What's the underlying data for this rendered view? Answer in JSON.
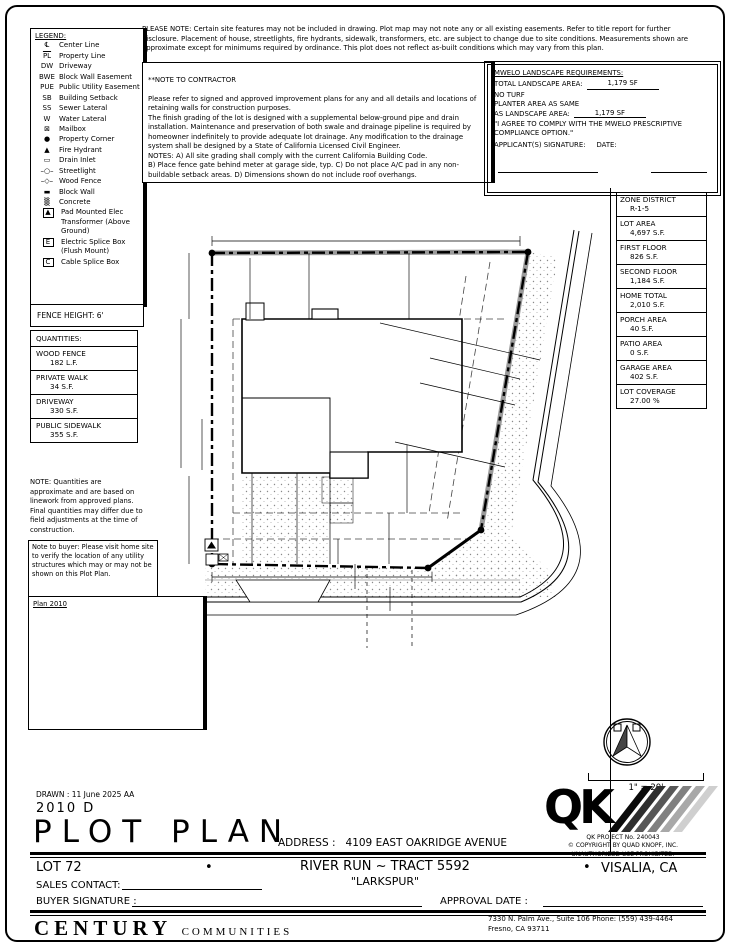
{
  "top_note": "PLEASE NOTE:  Certain site features may not be included in drawing.  Plot map may not note any or all existing easements.  Refer to title report for further disclosure.  Placement of house, streetlights, fire hydrants, sidewalk, transformers, etc. are subject to change due to site conditions.  Measurements shown are approximate except for minimums required by ordinance.  This plot does not reflect as-built conditions which may vary from this plan.",
  "contractor_note": {
    "title": "**NOTE TO CONTRACTOR",
    "body": "Please refer to signed and approved improvement plans for any and all details and locations of retaining walls for construction purposes.\nThe finish grading of the lot is designed with a supplemental below-ground pipe and drain installation.  Maintenance and preservation of both swale and drainage pipeline is required by homeowner indefinitely to provide adequate lot drainage.  Any modification to the drainage system shall be designed by a State of California Licensed Civil Engineer.\nNOTES:  A) All site grading shall comply with the current California Building Code.\nB) Place fence gate behind meter at garage side, typ.  C) Do not place A/C pad in any non-buildable setback areas.  D) Dimensions shown do not include roof overhangs."
  },
  "mwelo": {
    "title": "MWELO LANDSCAPE REQUIREMENTS:",
    "total_label": "TOTAL LANDSCAPE AREA:",
    "total_value": "1,179 SF",
    "no_turf": "NO TURF",
    "planter_label1": "PLANTER AREA AS SAME",
    "planter_label2": "AS LANDSCAPE AREA:",
    "planter_value": "1,179 SF",
    "agree": "\"I AGREE TO COMPLY WITH THE MWELO PRESCRIPTIVE COMPLIANCE OPTION.\"",
    "signature_label": "APPLICANT(S) SIGNATURE:",
    "date_label": "DATE:"
  },
  "legend": {
    "title": "LEGEND:",
    "items": [
      {
        "sym": "℄",
        "name": "centerline-icon",
        "label": "Center Line"
      },
      {
        "sym": "PL",
        "ov": 1,
        "name": "property-line-icon",
        "label": "Property Line"
      },
      {
        "sym": "DW",
        "name": "driveway-abbr",
        "label": "Driveway"
      },
      {
        "sym": "BWE",
        "name": "block-wall-easement-abbr",
        "label": "Block Wall Easement"
      },
      {
        "sym": "PUE",
        "name": "public-utility-easement-abbr",
        "label": "Public Utility Easement"
      },
      {
        "sym": "SB",
        "name": "building-setback-abbr",
        "label": "Building Setback"
      },
      {
        "sym": "SS",
        "name": "sewer-lateral-abbr",
        "label": "Sewer Lateral"
      },
      {
        "sym": "W",
        "name": "water-lateral-abbr",
        "label": "Water Lateral"
      },
      {
        "sym": "⊠",
        "name": "mailbox-icon",
        "label": "Mailbox"
      },
      {
        "sym": "●",
        "name": "property-corner-icon",
        "label": "Property Corner"
      },
      {
        "sym": "▲",
        "name": "fire-hydrant-icon",
        "label": "Fire Hydrant"
      },
      {
        "sym": "▭",
        "name": "drain-inlet-icon",
        "label": "Drain Inlet"
      },
      {
        "sym": "–○–",
        "name": "streetlight-icon",
        "label": "Streetlight"
      },
      {
        "sym": "–◇–",
        "name": "wood-fence-icon",
        "label": "Wood Fence"
      },
      {
        "sym": "▬",
        "name": "block-wall-icon",
        "label": "Block Wall"
      },
      {
        "sym": "▒",
        "name": "concrete-icon",
        "label": "Concrete"
      },
      {
        "sym": "▲",
        "boxed": 1,
        "name": "transformer-icon",
        "label": "Pad Mounted Elec Transformer (Above Ground)"
      },
      {
        "sym": "E",
        "boxed": 1,
        "name": "electric-splice-box-icon",
        "label": "Electric Splice Box (Flush Mount)"
      },
      {
        "sym": "C",
        "boxed": 1,
        "name": "cable-splice-box-icon",
        "label": "Cable Splice Box"
      }
    ]
  },
  "fence_height": "FENCE HEIGHT: 6'",
  "quantities": {
    "title": "QUANTITIES:",
    "items": [
      {
        "name": "WOOD FENCE",
        "value": "182 L.F."
      },
      {
        "name": "PRIVATE WALK",
        "value": "34 S.F."
      },
      {
        "name": "DRIVEWAY",
        "value": "330 S.F."
      },
      {
        "name": "PUBLIC SIDEWALK",
        "value": "355 S.F."
      }
    ]
  },
  "quantities_note": "NOTE: Quantities are approximate and are based on linework from approved plans. Final quantities may differ due to field adjustments at the time of construction.",
  "buyer_note": "Note to buyer: Please visit home site to verify the location of any utility structures which may or may not be shown on this Plot Plan.",
  "pv": {
    "title": "Plan 2010",
    "lines": [
      {
        "t": "PV SYSTEM:",
        "i": 0
      },
      {
        "t": "INVERTER:",
        "i": 1
      },
      {
        "t": "SOLAREDGE SE 3800H-USSR",
        "i": 2
      },
      {
        "t": "SOLAR MODULE TYPE:",
        "i": 1
      },
      {
        "t": "JASOLAR, JAM54S31-405/MR",
        "i": 2
      },
      {
        "t": "SYSTEM SIZE:",
        "i": 1
      },
      {
        "t": "12 MODULES 4.86Kw DC/",
        "i": 2
      },
      {
        "t": "3.800KW AC (405w)",
        "i": 2
      },
      {
        "t": "ENERGY STORAGE SYSTEM:",
        "i": 1
      },
      {
        "t": "(1) TELSA POWERWALL 2,",
        "i": 2
      },
      {
        "t": "13.5kWh, 5kW",
        "i": 2
      }
    ]
  },
  "zone_table": {
    "rows": [
      {
        "label": "ZONE DISTRICT",
        "value": "R-1-5"
      },
      {
        "label": "LOT AREA",
        "value": "4,697 S.F."
      },
      {
        "label": "FIRST FLOOR",
        "value": "826 S.F."
      },
      {
        "label": "SECOND FLOOR",
        "value": "1,184 S.F."
      },
      {
        "label": "HOME TOTAL",
        "value": "2,010 S.F."
      },
      {
        "label": "PORCH AREA",
        "value": "40 S.F."
      },
      {
        "label": "PATIO AREA",
        "value": "0 S.F."
      },
      {
        "label": "GARAGE AREA",
        "value": "402 S.F."
      },
      {
        "label": "LOT COVERAGE",
        "value": "27.00 %"
      }
    ]
  },
  "side_notes": [
    "All easements, structures, utility lines, underground systems & conditions affecting construction on the parcel must be shown & are the responsibility of the applicant. The issuance of a permit does not grant to any person the right to violate City or State Law.",
    "Issuance of the building permit does not constitute approval of paving, concrete curbs, gutters, sidewalks & driveway approaches in street or alley right-of-way adjacent to the property. Separate permits are required for such work per applicable City standards. Issuance of a Certificate of Occupancy for the building is dependent upon prior satisfactory completion of required pavement and concrete work."
  ],
  "compass": {
    "n": "N",
    "scale": "1\" = 20'"
  },
  "qk": {
    "logo": "QK",
    "line1": "QK PROJECT No. 240043",
    "line2": "© COPYRIGHT BY QUAD KNOPF, INC.",
    "line3": "UNAUTHORIZED USE PROHIBITED."
  },
  "title_block": {
    "drawn": "DRAWN :  11 June 2025   AA",
    "plan_code": "2010  D",
    "title": "PLOT PLAN",
    "address_label": "ADDRESS :",
    "address": "4109 EAST OAKRIDGE AVENUE",
    "lot": "LOT  72",
    "bullet": "•",
    "tract": "RIVER RUN ~ TRACT 5592",
    "community": "\"LARKSPUR\"",
    "city": "VISALIA, CA",
    "sales_label": "SALES CONTACT:",
    "buyer_label": "BUYER SIGNATURE :",
    "approval_label": "APPROVAL DATE :"
  },
  "footer": {
    "brand_main": "CENTURY",
    "brand_sub": "COMMUNITIES",
    "addr1": "7330 N. Palm Ave., Suite 106    Phone:  (559) 439-4464",
    "addr2": "Fresno, CA  93711"
  },
  "site_plan": {
    "labels": [
      {
        "t": "72.89'",
        "x": 415,
        "y": 246,
        "s": 9
      },
      {
        "t": "PL",
        "x": 500,
        "y": 246,
        "s": 8,
        "ov": 1
      },
      {
        "t": "STEM WALL",
        "x": 372,
        "y": 266,
        "s": 8
      },
      {
        "t": "72",
        "x": 437,
        "y": 297,
        "s": 17,
        "b": 1
      },
      {
        "t": "16.24'",
        "x": 189,
        "y": 288,
        "r": -90,
        "s": 8
      },
      {
        "t": "16.26'",
        "x": 250,
        "y": 288,
        "r": -90,
        "s": 8
      },
      {
        "t": "15' SB",
        "x": 309,
        "y": 282,
        "r": -90,
        "s": 8
      },
      {
        "t": "16.33'",
        "x": 409,
        "y": 283,
        "r": -90,
        "s": 8
      },
      {
        "t": "PL",
        "x": 204,
        "y": 313,
        "s": 8,
        "ov": 1
      },
      {
        "t": "AC",
        "x": 275,
        "y": 316,
        "s": 7
      },
      {
        "t": "PLAN 2010",
        "x": 341,
        "y": 351,
        "s": 13
      },
      {
        "t": "ELEV D",
        "x": 341,
        "y": 364,
        "s": 10,
        "u": 1
      },
      {
        "t": "2-STORY",
        "x": 341,
        "y": 375,
        "s": 9
      },
      {
        "t": "24.93'",
        "x": 452,
        "y": 336,
        "r": -13,
        "s": 8
      },
      {
        "t": "STEM WALL",
        "x": 507,
        "y": 303,
        "r": -80,
        "s": 8
      },
      {
        "t": "PL",
        "x": 524,
        "y": 320,
        "s": 8,
        "ov": 1
      },
      {
        "t": "21.24'",
        "x": 589,
        "y": 302,
        "r": -80,
        "s": 8
      },
      {
        "t": "10' SB",
        "x": 483,
        "y": 368,
        "r": -13,
        "s": 8
      },
      {
        "t": "6' PUE",
        "x": 478,
        "y": 394,
        "r": -13,
        "s": 8
      },
      {
        "t": "5' SB",
        "x": 221,
        "y": 333,
        "s": 8
      },
      {
        "t": "7.00'",
        "x": 232,
        "y": 358,
        "s": 8
      },
      {
        "t": "35.11'",
        "x": 181,
        "y": 406,
        "r": -90,
        "s": 8
      },
      {
        "t": "12.05'",
        "x": 202,
        "y": 432,
        "r": -90,
        "s": 8
      },
      {
        "t": "GATE",
        "x": 239,
        "y": 449,
        "r": -90,
        "s": 7
      },
      {
        "t": "2 - CAR",
        "x": 288,
        "y": 429,
        "s": 10
      },
      {
        "t": "GARAGE",
        "x": 288,
        "y": 441,
        "s": 10
      },
      {
        "t": "PORCH",
        "x": 349,
        "y": 468,
        "s": 8
      },
      {
        "t": "19.46'",
        "x": 449,
        "y": 452,
        "r": -12,
        "s": 8
      },
      {
        "t": "63.30'",
        "x": 501,
        "y": 440,
        "r": -80,
        "s": 8
      },
      {
        "t": "24.50'",
        "x": 561,
        "y": 412,
        "r": -80,
        "s": 8
      },
      {
        "t": "N SOL STREET",
        "x": 574,
        "y": 430,
        "r": -74,
        "s": 13,
        "ls": 1
      },
      {
        "t": "25.12'",
        "x": 407,
        "y": 492,
        "r": -90,
        "s": 8
      },
      {
        "t": "12' SB",
        "x": 389,
        "y": 538,
        "r": -90,
        "s": 8
      },
      {
        "t": "12.51'",
        "x": 547,
        "y": 517,
        "r": -80,
        "s": 8
      },
      {
        "t": "20.63'",
        "x": 189,
        "y": 514,
        "r": -90,
        "s": 8
      },
      {
        "t": "20.40'",
        "x": 252,
        "y": 518,
        "r": -90,
        "s": 8
      },
      {
        "t": "20.44'",
        "x": 297,
        "y": 513,
        "r": -90,
        "s": 8
      },
      {
        "t": "6' PUE",
        "x": 338,
        "y": 541,
        "r": -90,
        "s": 8
      },
      {
        "t": "14.66'",
        "x": 449,
        "y": 550,
        "r": -36,
        "s": 8
      },
      {
        "t": "DW",
        "x": 255,
        "y": 559,
        "s": 8
      },
      {
        "t": "50.03'",
        "x": 321,
        "y": 587,
        "s": 9
      },
      {
        "t": "5.00'",
        "x": 355,
        "y": 578,
        "r": -90,
        "s": 8
      },
      {
        "t": "PL",
        "x": 376,
        "y": 574,
        "s": 8,
        "ov": 1
      },
      {
        "t": "5.00'",
        "x": 390,
        "y": 600,
        "r": -90,
        "s": 8
      },
      {
        "t": "SS",
        "x": 370,
        "y": 615,
        "s": 8
      },
      {
        "t": "W",
        "x": 415,
        "y": 625,
        "s": 8
      },
      {
        "t": "C",
        "x": 212,
        "y": 562,
        "s": 7
      },
      {
        "t": "E OAKRIDGE AVENUE",
        "x": 367,
        "y": 657,
        "s": 13,
        "ls": 1
      }
    ]
  }
}
